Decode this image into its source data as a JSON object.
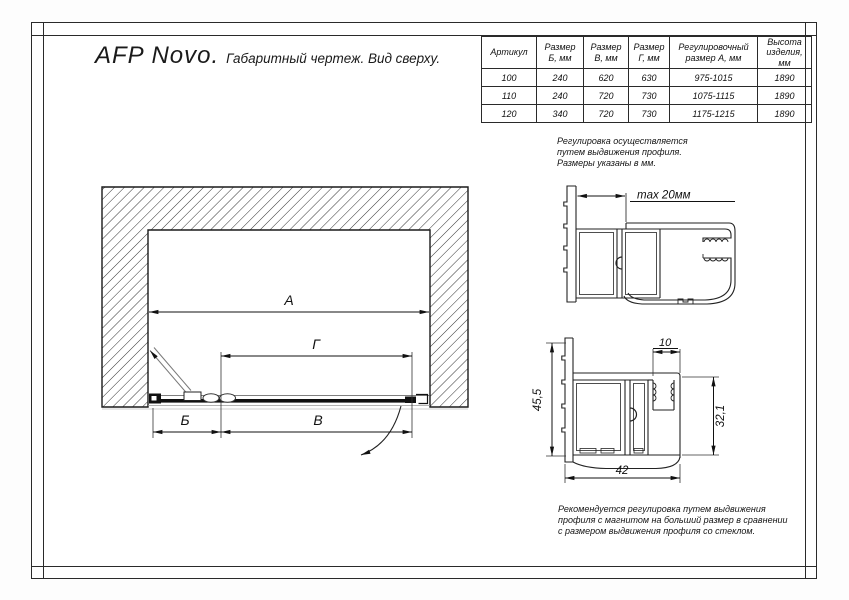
{
  "title": {
    "main": "AFP Novo.",
    "sub": "Габаритный чертеж. Вид сверху."
  },
  "table": {
    "headers": [
      "Артикул",
      "Размер\nБ, мм",
      "Размер\nВ, мм",
      "Размер\nГ, мм",
      "Регулировочный\nразмер А, мм",
      "Высота\nизделия,\nмм"
    ],
    "rows": [
      [
        "100",
        "240",
        "620",
        "630",
        "975-1015",
        "1890"
      ],
      [
        "110",
        "240",
        "720",
        "730",
        "1075-1115",
        "1890"
      ],
      [
        "120",
        "340",
        "720",
        "730",
        "1175-1215",
        "1890"
      ]
    ]
  },
  "notes": {
    "adjustment": "Регулировка осуществляется\nпутем выдвижения профиля.\nРазмеры указаны в мм.",
    "recommendation": "Рекомендуется регулировка путем выдвижения\nпрофиля с магнитом на больший размер в сравнении\nс размером выдвижения профиля со стеклом."
  },
  "dimensions": {
    "a": "А",
    "g": "Г",
    "b": "Б",
    "v": "В",
    "max_offset": "max 20мм",
    "profile_height": "45,5",
    "slot_width": "10",
    "inner_height": "32,1",
    "profile_width": "42"
  },
  "colors": {
    "line": "#1a1a1a",
    "thin_gray": "#9a9a9a",
    "background": "#ffffff"
  }
}
